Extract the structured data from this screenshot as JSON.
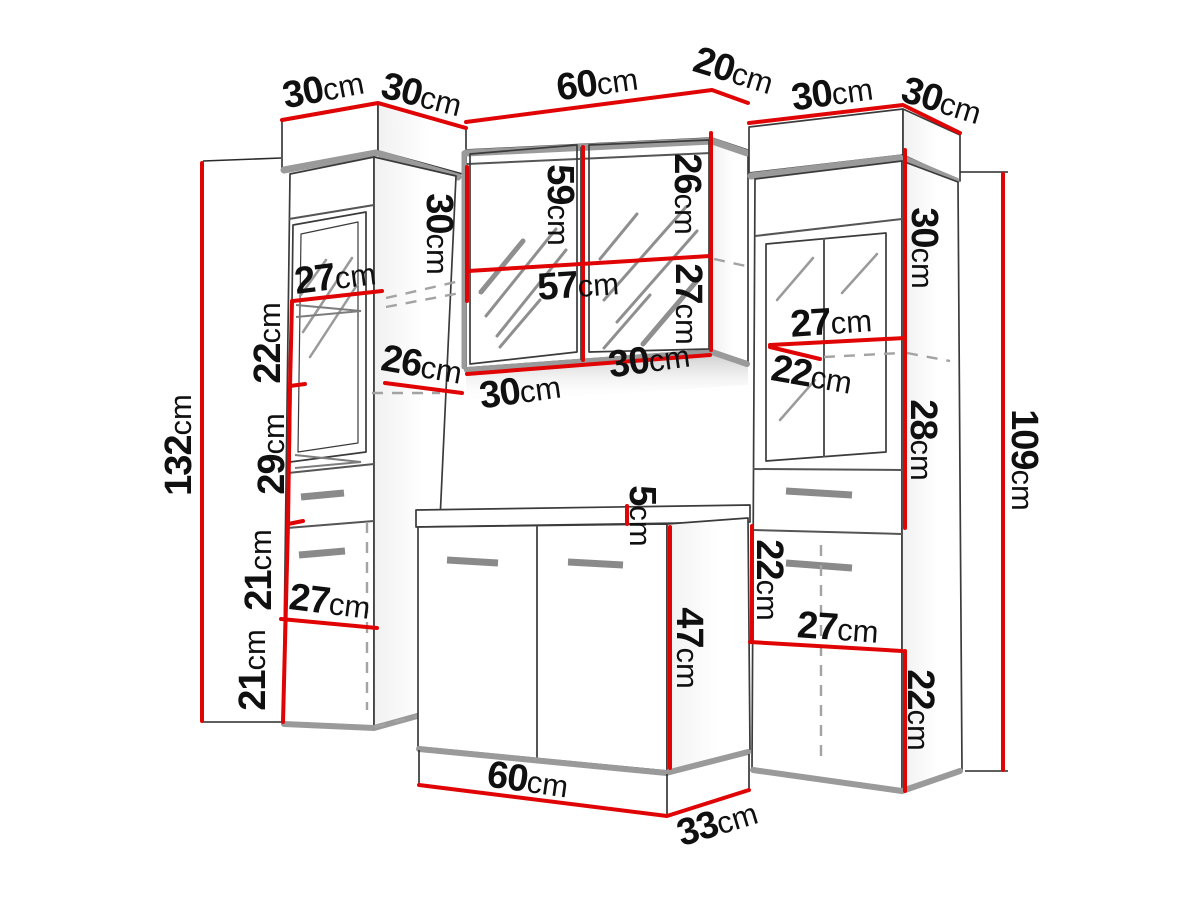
{
  "unit": "cm",
  "colors": {
    "dimension_line": "#e00404",
    "outline": "#3b3b3b",
    "shadow": "#9a9a9a",
    "text": "#101010",
    "background": "#ffffff"
  },
  "cabinets": {
    "left_column": {
      "width": "30",
      "depth": "30",
      "height": "132",
      "shelf_top": "27",
      "upper_gap": "22",
      "middle_gap": "29",
      "shelf_depth": "26",
      "lower_gap_a": "21",
      "lower_gap_b": "21",
      "shelf_bottom": "27"
    },
    "mirror_cabinet": {
      "width": "60",
      "depth": "20",
      "height": "59",
      "top_offset": "30",
      "upper_section": "26",
      "inner_width": "57",
      "lower_section": "27",
      "door_left": "30",
      "door_right": "30"
    },
    "vanity": {
      "width": "60",
      "depth": "33",
      "height": "47",
      "countertop": "5"
    },
    "right_column": {
      "width": "30",
      "depth": "30",
      "height": "109",
      "upper_section": "30",
      "shelf_top": "27",
      "shelf_depth": "22",
      "middle_section": "28",
      "drawer_gap": "22",
      "shelf_bottom": "27",
      "lower_gap": "22"
    }
  }
}
